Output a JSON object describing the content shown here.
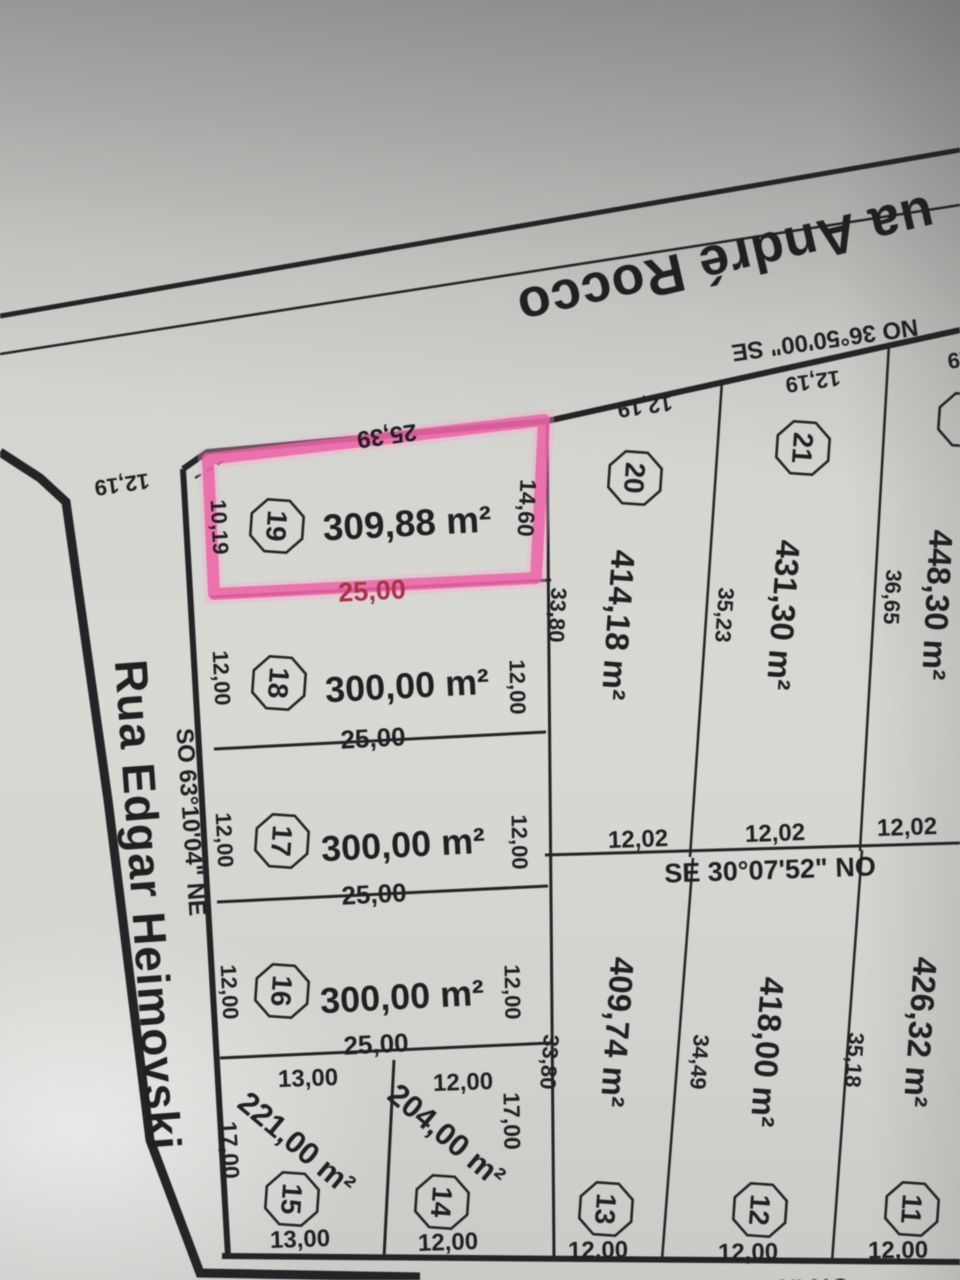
{
  "streets": {
    "top": {
      "name": "ua André Rocco",
      "bearing": "NO 36°50'00\" SE"
    },
    "left": {
      "name": "Rua Edgar Heimovski",
      "bearing": "SO 63°10'04\" NE"
    }
  },
  "survey": {
    "middle": {
      "bearing": "SE 30°07'52\" NO",
      "widths": [
        "12,02",
        "12,02",
        "12,02"
      ]
    },
    "bottom": {
      "bearing_partial": "SE 30°40'50\" NO"
    }
  },
  "frontages": {
    "corner": "12,19",
    "lot20": "12,19",
    "lot21": "12,19",
    "lot22_partial": "12,19"
  },
  "lots": {
    "l19": {
      "number": "19",
      "area": "309,88 m²",
      "front": "25,39",
      "left": "10,19",
      "right": "14,60",
      "rear": "25,00",
      "highlighted": true
    },
    "l18": {
      "number": "18",
      "area": "300,00 m²",
      "left": "12,00",
      "right": "12,00",
      "rear": "25,00"
    },
    "l17": {
      "number": "17",
      "area": "300,00 m²",
      "left": "12,00",
      "right": "12,00",
      "rear": "25,00"
    },
    "l16": {
      "number": "16",
      "area": "300,00 m²",
      "left": "12,00",
      "right": "12,00",
      "rear": "25,00"
    },
    "l15": {
      "number": "15",
      "area": "221,00 m²",
      "front": "13,00",
      "left": "17,00",
      "rear": "13,00"
    },
    "l14": {
      "number": "14",
      "area": "204,00 m²",
      "front": "12,00",
      "right": "17,00",
      "rear": "12,00"
    },
    "l20": {
      "number": "20",
      "area": "414,18 m²",
      "side": "33,80"
    },
    "l21": {
      "number": "21",
      "area": "431,30 m²",
      "side": "35,23"
    },
    "l22": {
      "area": "448,30 m²",
      "side": "36,65"
    },
    "l13": {
      "number": "13",
      "area": "409,74 m²",
      "side": "33,80",
      "rear": "12,00"
    },
    "l12": {
      "number": "12",
      "area": "418,00 m²",
      "side": "34,49",
      "rear": "12,00"
    },
    "l11": {
      "number": "11",
      "area": "426,32 m²",
      "side": "35,18",
      "rear": "12,00"
    }
  },
  "highlight": {
    "lot": "19",
    "stroke": "#ee5fa3",
    "glow": "#f6a9cc",
    "rear_label_color": "#a83349"
  }
}
